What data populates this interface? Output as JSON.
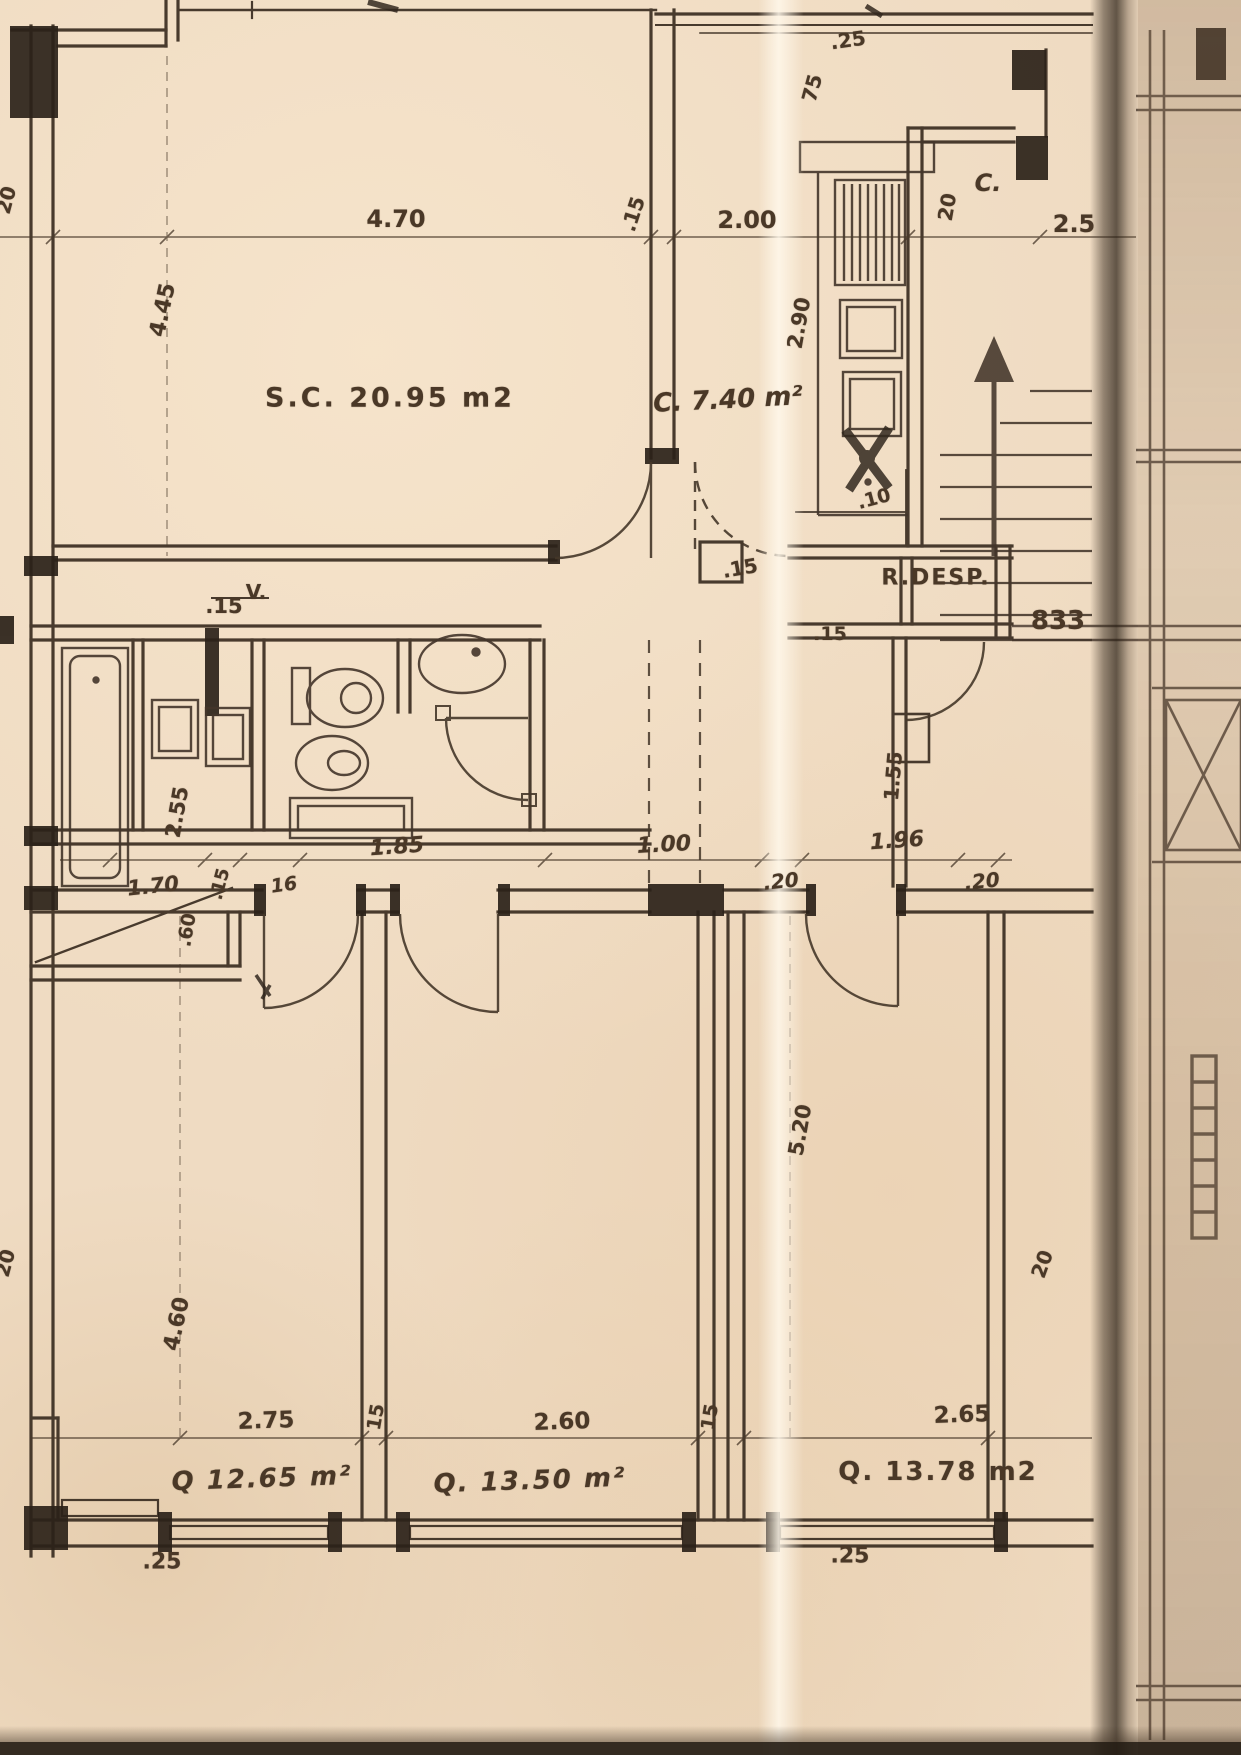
{
  "plan": {
    "rooms": {
      "living": "S.C. 20.95 m2",
      "kitchen": "C. 7.40 m²",
      "cupboard": "C.",
      "pantry": "R.DESP.",
      "vent": "V.",
      "bedroom1": "Q 12.65 m²",
      "bedroom2": "Q. 13.50 m²",
      "bedroom3": "Q. 13.78 m2"
    },
    "dims": {
      "top_offset": ".25",
      "top_wall_vert": "75",
      "living_width": "4.70",
      "top_wall": ".15",
      "kitchen_width": "2.00",
      "cupboard_depth": "20",
      "stair_width": "2.5",
      "living_height": "4.45",
      "kitchen_depth": "2.90",
      "pantry_clear": ".10",
      "shaft_wall": ".15",
      "hall_wall": ".15",
      "bath_wall_top": ".15",
      "bath_depth": "2.55",
      "bath_width": "1.85",
      "hall_width": "1.00",
      "pantry_width": "1.96",
      "duct_left": ".20",
      "duct_right": ".20",
      "closet_depth": "1.55",
      "laundry_width": "1.70",
      "laundry_wall": ".15",
      "wall_16": "16",
      "balcony_depth": ".60",
      "bed1_depth": "4.60",
      "bed3_depth": "5.20",
      "bed1_width": "2.75",
      "wall_12": "15",
      "bed2_width": "2.60",
      "wall_23": "15",
      "bed3_width": "2.65",
      "right_wall": "20",
      "bottom_left": ".25",
      "bottom_right": ".25",
      "edge_top": "20",
      "edge_bottom": "20"
    },
    "annotations": {
      "stair_ref": "833"
    }
  },
  "colors": {
    "paper": "#efdbc2",
    "ink": "#43352a",
    "wall_fill": "#2b2219",
    "fold_shadow": "#5f5142",
    "margin_paper": "#d9c5a9"
  }
}
